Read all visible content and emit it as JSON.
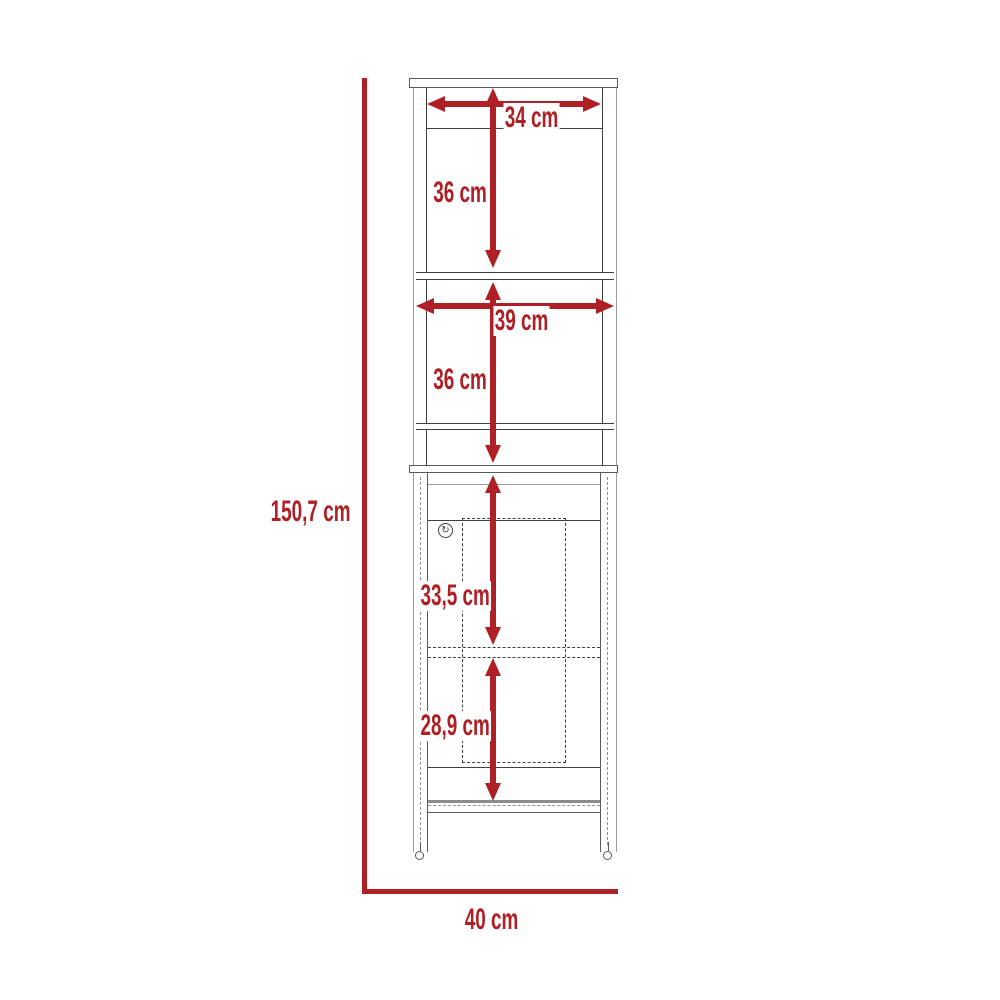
{
  "diagram": {
    "title": "Cabinet dimension diagram (front view)",
    "background_color": "#ffffff",
    "accent_color": "#ae2026",
    "line_light": "#9b9b9b",
    "line_mid": "#5a5a5a",
    "line_dark": "#3f3f3f"
  },
  "dimensions": {
    "overall_height": "150,7 cm",
    "overall_width": "40 cm",
    "top_opening_width": "34 cm",
    "upper_section_height": "36 cm",
    "middle_width": "39 cm",
    "middle_section_height": "36 cm",
    "door_section_height": "33,5 cm",
    "bottom_section_height": "28,9 cm"
  },
  "icons": {
    "door_knob": "↻"
  }
}
